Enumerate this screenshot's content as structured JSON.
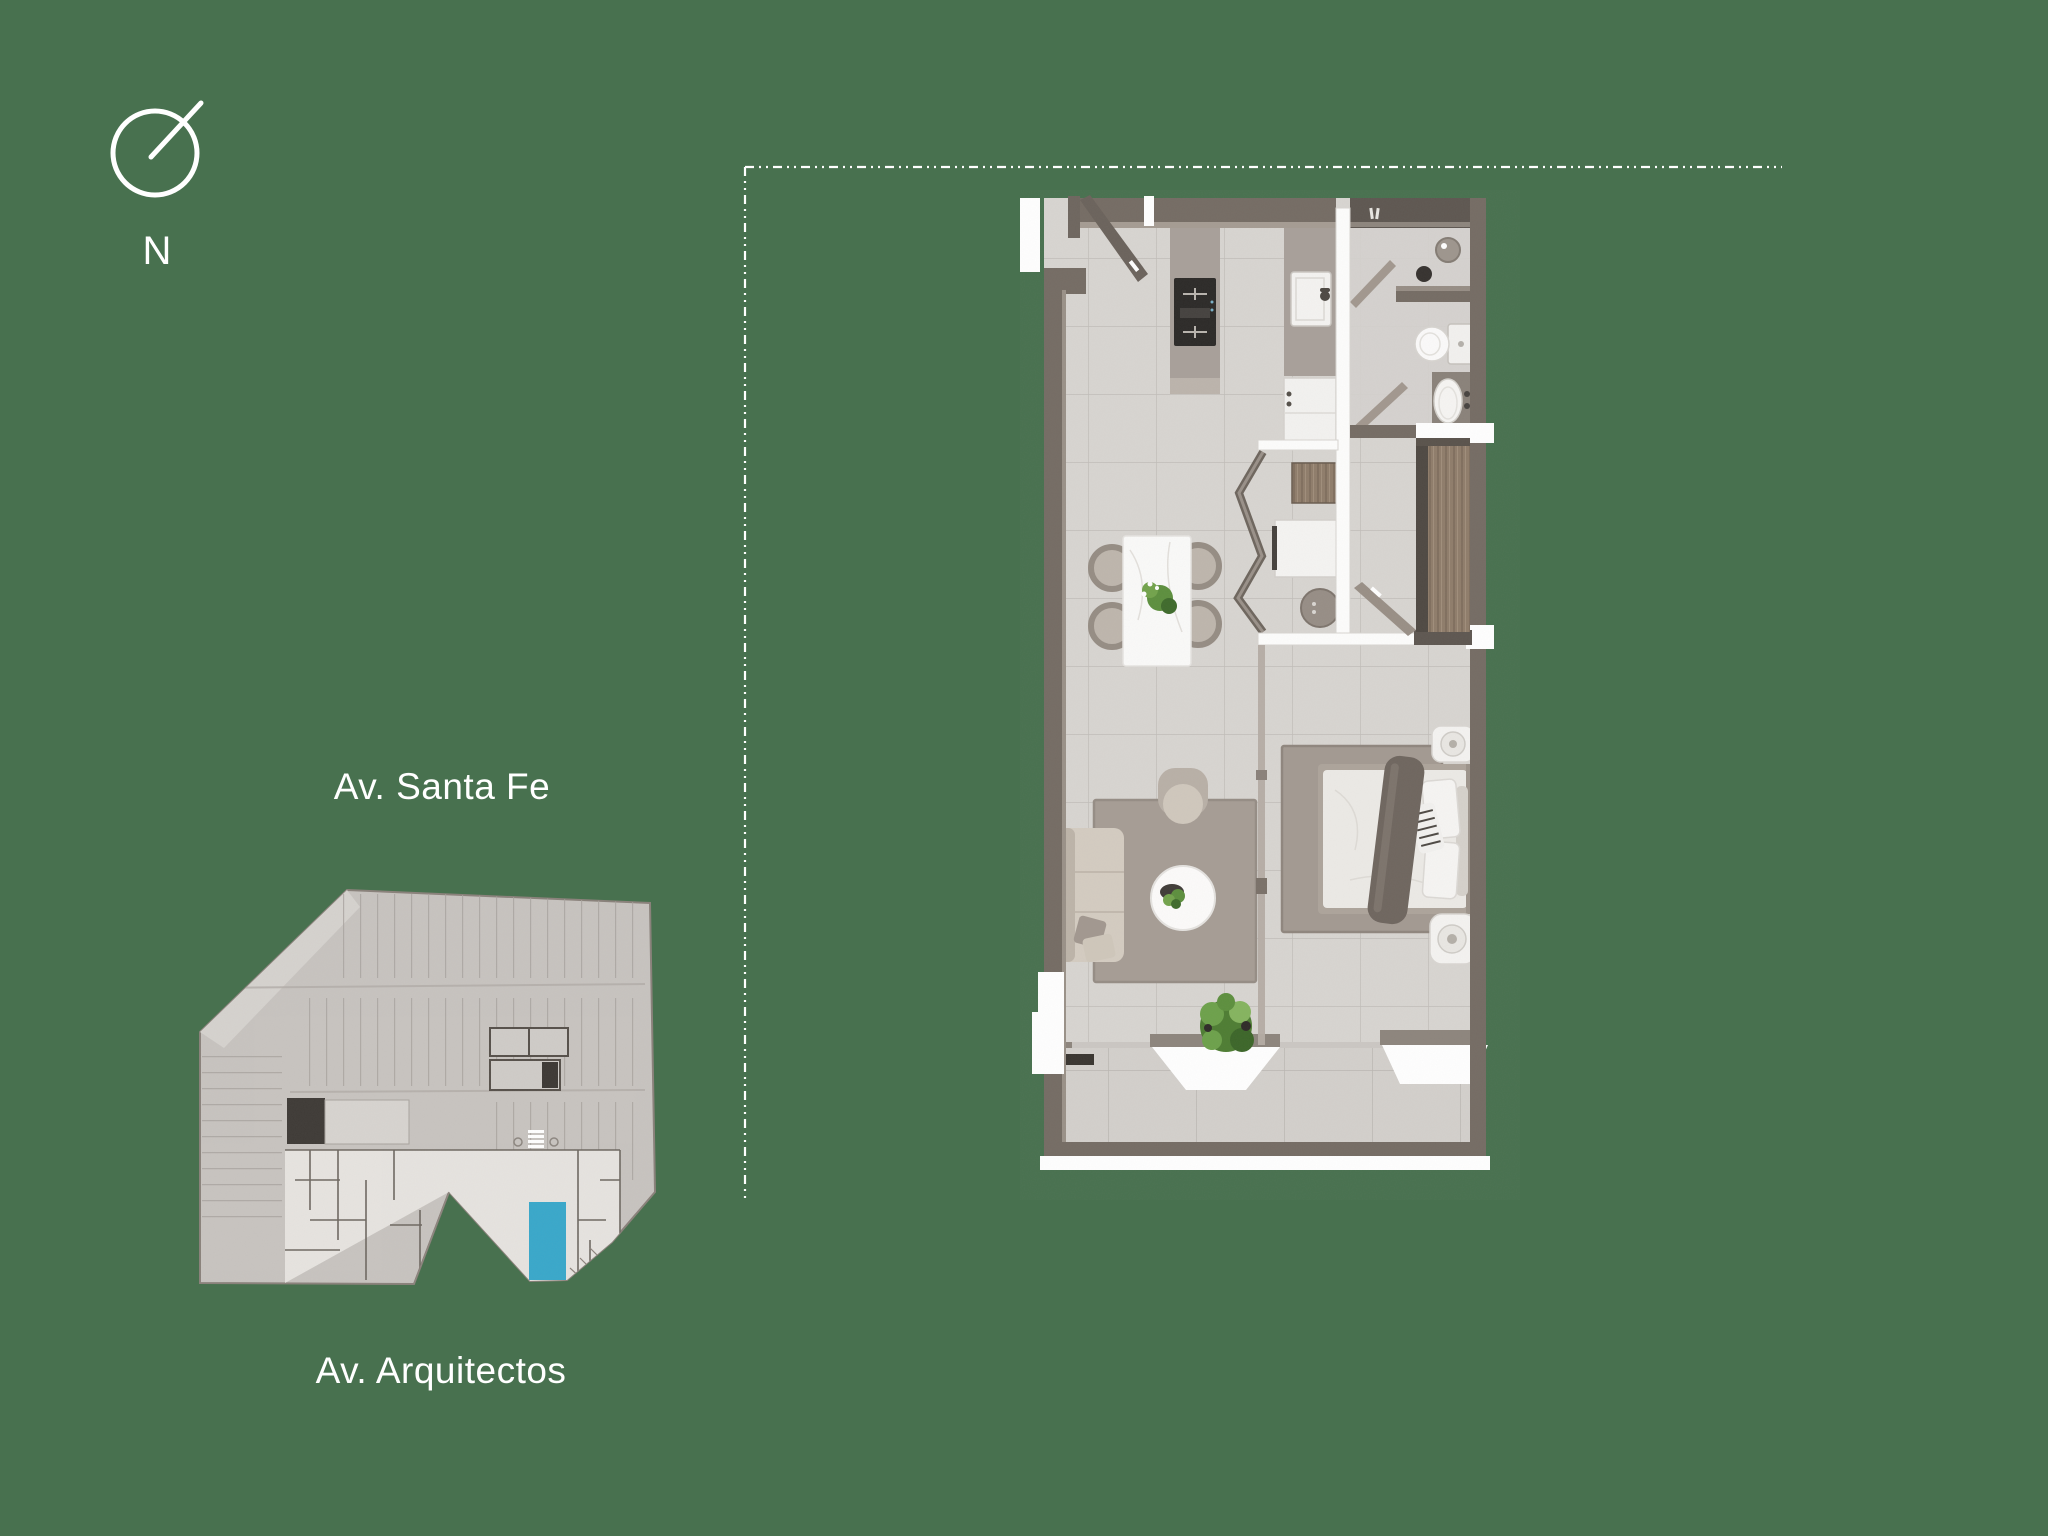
{
  "canvas": {
    "width": 2048,
    "height": 1536,
    "background": "#48714F"
  },
  "compass": {
    "label": "N"
  },
  "labels": {
    "street_top": "Av. Santa Fe",
    "street_bottom": "Av. Arquitectos"
  },
  "boundary": {
    "style": "dash-dot",
    "color": "#FFFFFF"
  },
  "site_plan": {
    "highlighted_unit_color": "#39A8CB",
    "footprint_color": "#C8C4C0"
  },
  "floor_plan": {
    "wall_color": "#756C64",
    "floor_color": "#D8D5D1",
    "wood_color": "#8F7D6B",
    "greenery_color": "#5D8F3E",
    "rug_color": "#A49B93"
  },
  "icons": {
    "compass": "north-needle-circle",
    "shower": "shower-ticks",
    "doors": "swing-leaf",
    "sliding_openings": "white-wedge"
  }
}
